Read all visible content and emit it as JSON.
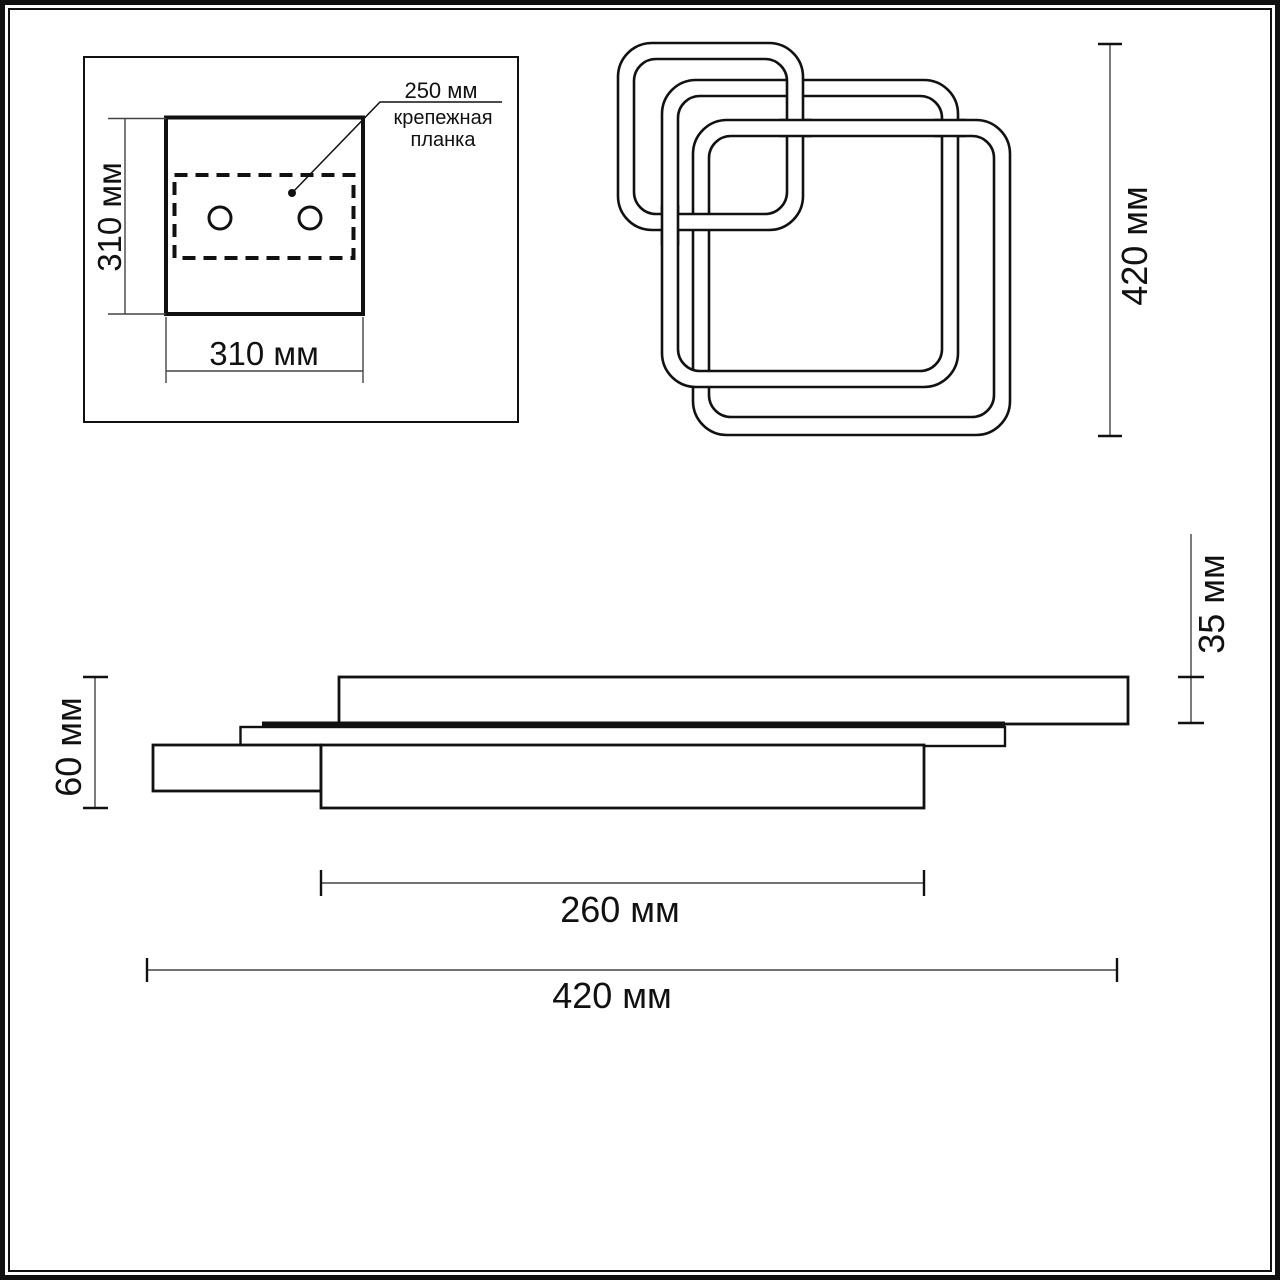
{
  "page": {
    "background": "#ffffff",
    "line_color": "#111111",
    "dim_line_color": "#444444"
  },
  "mounting_plate_view": {
    "bracket_label": {
      "size": "250 мм",
      "name_line1": "крепежная",
      "name_line2": "планка"
    },
    "plate_height": "310 мм",
    "plate_width": "310 мм"
  },
  "front_view": {
    "overall_height": "420 мм"
  },
  "side_view": {
    "overall_thickness": "60 мм",
    "top_ring_thickness": "35 мм",
    "inner_ring_width": "260 мм",
    "overall_width": "420 мм"
  }
}
